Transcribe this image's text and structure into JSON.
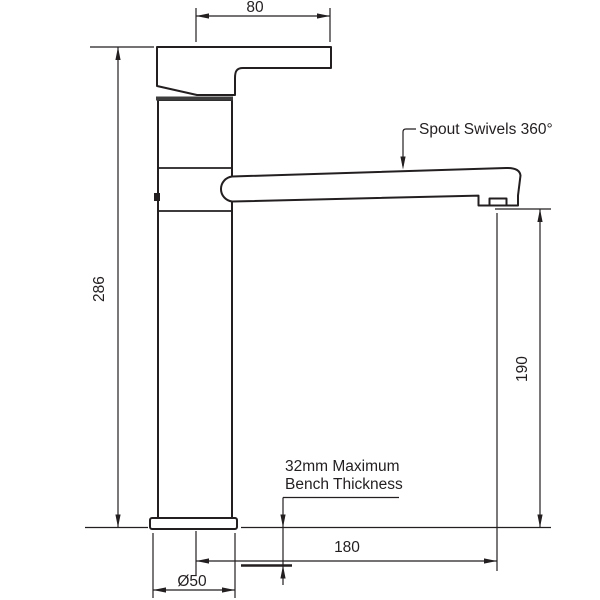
{
  "drawing": {
    "background": "#ffffff",
    "line_color": "#231f20",
    "dimensions": {
      "handle_width": "80",
      "total_height": "286",
      "spout_clearance": "190",
      "spout_reach": "180",
      "base_diameter": "Ø50"
    },
    "annotations": {
      "spout_swivel": "Spout Swivels 360°",
      "bench_note_line1": "32mm Maximum",
      "bench_note_line2": "Bench Thickness"
    }
  }
}
